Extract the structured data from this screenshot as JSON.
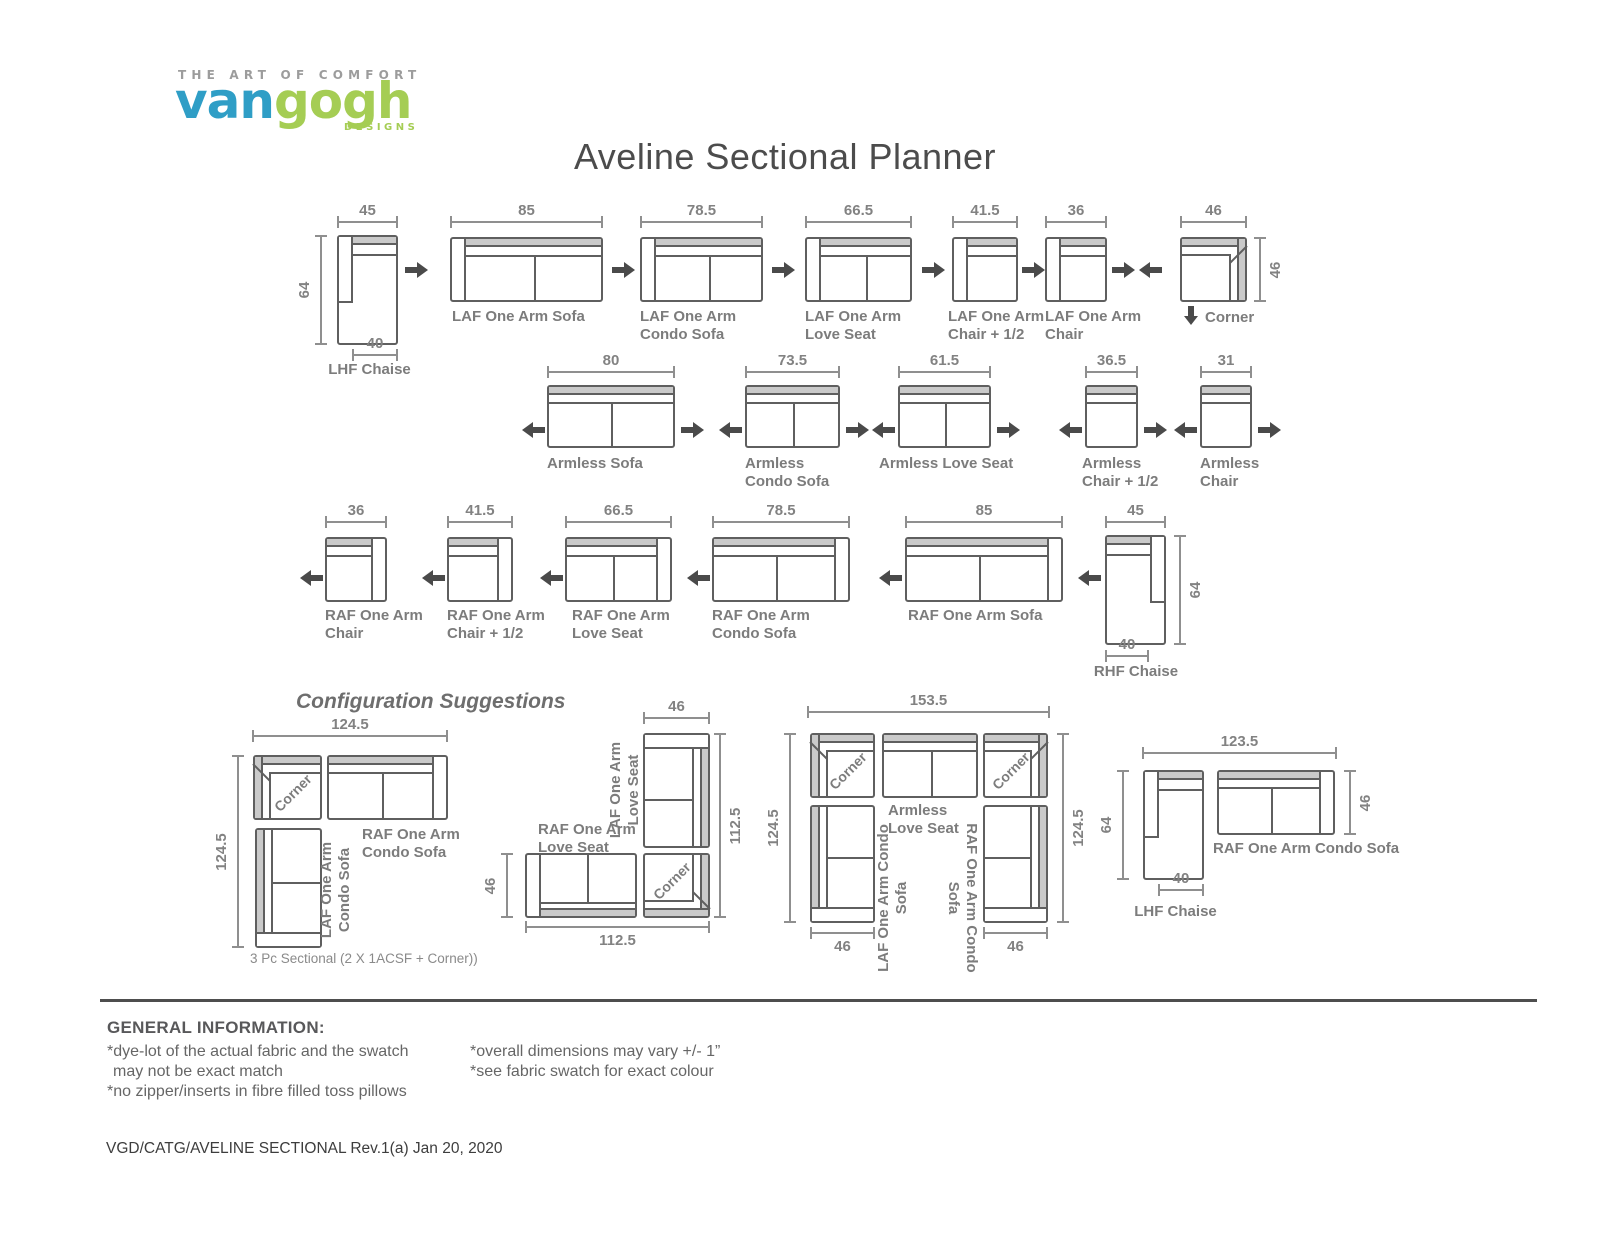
{
  "logo": {
    "tagline": "THE ART OF COMFORT",
    "van": "van",
    "gogh": "gogh",
    "designs": "DESIGNS"
  },
  "title": "Aveline Sectional Planner",
  "laf_row": {
    "chaise": {
      "label": "LHF Chaise",
      "width": "45",
      "depth": "64",
      "seat": "40"
    },
    "sofa": {
      "label": "LAF One Arm Sofa",
      "width": "85"
    },
    "condo_sofa": {
      "label": "LAF One Arm Condo Sofa",
      "width": "78.5"
    },
    "love_seat": {
      "label": "LAF One Arm Love Seat",
      "width": "66.5"
    },
    "chair_half": {
      "label": "LAF One Arm Chair + 1/2",
      "width": "41.5"
    },
    "chair": {
      "label": "LAF One Arm Chair",
      "width": "36"
    },
    "corner": {
      "label": "Corner",
      "width": "46",
      "depth": "46"
    }
  },
  "armless_row": {
    "sofa": {
      "label": "Armless Sofa",
      "width": "80"
    },
    "condo_sofa": {
      "label": "Armless Condo Sofa",
      "width": "73.5"
    },
    "love_seat": {
      "label": "Armless Love Seat",
      "width": "61.5"
    },
    "chair_half": {
      "label": "Armless Chair + 1/2",
      "width": "36.5"
    },
    "chair": {
      "label": "Armless Chair",
      "width": "31"
    }
  },
  "raf_row": {
    "chair": {
      "label": "RAF One Arm Chair",
      "width": "36"
    },
    "chair_half": {
      "label": "RAF One Arm Chair + 1/2",
      "width": "41.5"
    },
    "love_seat": {
      "label": "RAF One Arm Love Seat",
      "width": "66.5"
    },
    "condo_sofa": {
      "label": "RAF One Arm Condo Sofa",
      "width": "78.5"
    },
    "sofa": {
      "label": "RAF One Arm Sofa",
      "width": "85"
    },
    "chaise": {
      "label": "RHF Chaise",
      "width": "45",
      "depth": "64",
      "seat": "40"
    }
  },
  "configs": {
    "heading": "Configuration Suggestions",
    "c1": {
      "top": "124.5",
      "side": "124.5",
      "corner": "Corner",
      "sofa_top": "RAF One Arm Condo Sofa",
      "sofa_side": "LAF One Arm Condo Sofa",
      "caption": "3 Pc Sectional (2 X 1ACSF + Corner))"
    },
    "c2": {
      "top": "46",
      "right": "112.5",
      "left": "46",
      "bottom": "112.5",
      "vertical": "LAF One Arm Love Seat",
      "horizontal": "RAF One Arm Love Seat",
      "corner": "Corner"
    },
    "c3": {
      "top": "153.5",
      "left": "124.5",
      "right": "124.5",
      "corner_l": "Corner",
      "corner_r": "Corner",
      "middle": "Armless Love Seat",
      "left_piece": "LAF One Arm Condo Sofa",
      "right_piece": "RAF One Arm Condo Sofa",
      "base_l": "46",
      "base_r": "46"
    },
    "c4": {
      "top": "123.5",
      "depth": "64",
      "seat": "40",
      "sofa_depth": "46",
      "chaise": "LHF Chaise",
      "sofa": "RAF One Arm Condo Sofa"
    }
  },
  "info": {
    "heading": "GENERAL INFORMATION:",
    "l1": "*dye-lot of the actual fabric and the swatch",
    "l2": "may not be exact match",
    "l3": "*no zipper/inserts in fibre filled toss pillows",
    "r1": "*overall dimensions may vary +/- 1”",
    "r2": "*see fabric swatch for exact colour"
  },
  "footer": "VGD/CATG/AVELINE SECTIONAL Rev.1(a) Jan 20, 2020",
  "colors": {
    "brand_blue": "#2f9ec6",
    "brand_green": "#a5cd54",
    "diagram_line": "#5f5f5f",
    "backrest_fill": "#cacaca",
    "label_gray": "#7c7c7c"
  }
}
